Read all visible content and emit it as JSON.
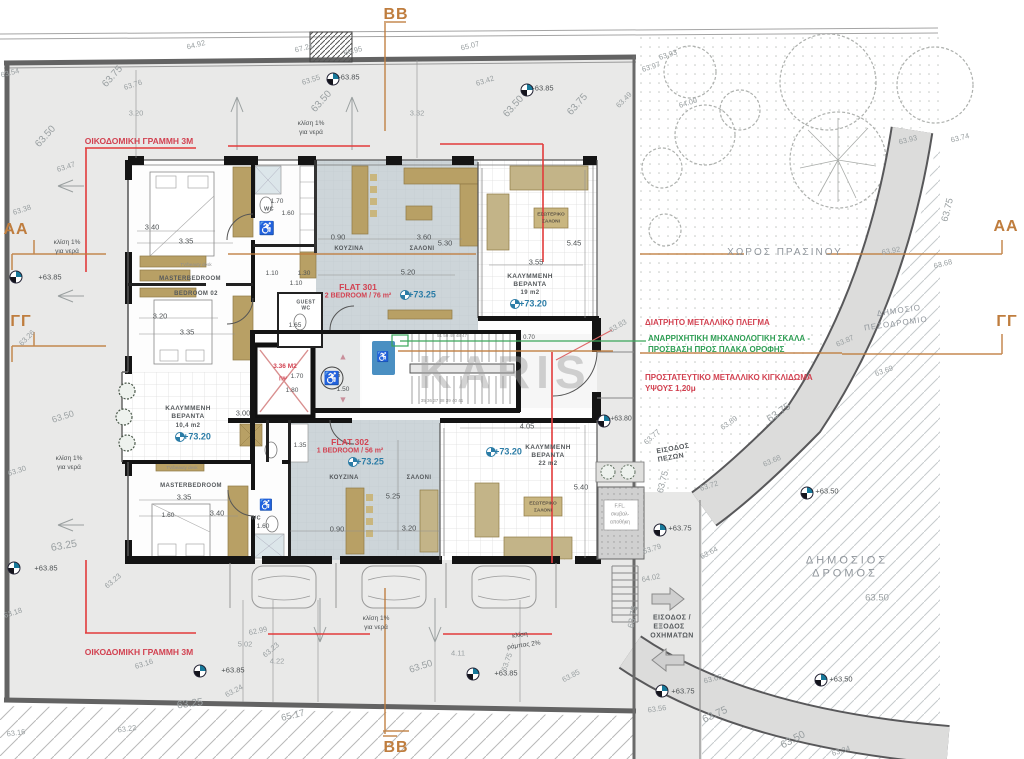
{
  "section_markers": {
    "top": "BB",
    "bottom": "BB",
    "left_a": "AA",
    "right_a": "AA",
    "left_g": "ΓΓ",
    "right_g": "ΓΓ"
  },
  "icons": {
    "wheelchair": "♿",
    "tri_up": "▲",
    "tri_down": "▼"
  },
  "flat301": {
    "name": "FLAT 301",
    "spec": "2 BEDROOM / 76 m²",
    "level": "+73.25"
  },
  "flat302": {
    "name": "FLAT 302",
    "spec": "1 BEDROOM / 56 m²",
    "level": "+73.25"
  },
  "labels": [
    {
      "n": "watermark",
      "t": "KARIS",
      "x": 505,
      "y": 372,
      "c": "wm",
      "s": 46,
      "ls": 6
    },
    {
      "n": "building-line-label-top",
      "t": "ΟΙΚΟΔΟΜΙΚΗ ΓΡΑΜΜΗ 3Μ",
      "x": 139,
      "y": 141,
      "c": "red",
      "s": 8.5
    },
    {
      "n": "building-line-label-bottom",
      "t": "ΟΙΚΟΔΟΜΙΚΗ ΓΡΑΜΜΗ 3Μ",
      "x": 139,
      "y": 652,
      "c": "red",
      "s": 8.5
    },
    {
      "n": "annotation-mesh",
      "t": "ΔΙΑΤΡΗΤΟ ΜΕΤΑΛΛΙΚΟ ΠΛΕΓΜΑ",
      "x": 645,
      "y": 323,
      "c": "red",
      "s": 8,
      "a": "l"
    },
    {
      "n": "annotation-ladder-1",
      "t": "ΑΝΑΡΡΙΧΗΤΙΚΗ ΜΗΧΑΝΟΛΟΓΙΚΗ ΣΚΑΛΑ -",
      "x": 648,
      "y": 339,
      "c": "grn",
      "s": 8,
      "a": "l"
    },
    {
      "n": "annotation-ladder-2",
      "t": "ΠΡΟΣΒΑΣΗ ΠΡΟΣ ΠΛΑΚΑ ΟΡΟΦΗΣ",
      "x": 648,
      "y": 350,
      "c": "grn",
      "s": 8,
      "a": "l"
    },
    {
      "n": "annotation-railing-1",
      "t": "ΠΡΟΣΤΑΤΕΥΤΙΚΟ ΜΕΤΑΛΛΙΚΟ ΚΙΓΚΛΙΔΩΜΑ",
      "x": 645,
      "y": 378,
      "c": "red",
      "s": 8,
      "a": "l"
    },
    {
      "n": "annotation-railing-2",
      "t": "ΥΨΟΥΣ 1,20μ",
      "x": 645,
      "y": 389,
      "c": "red",
      "s": 8,
      "a": "l"
    },
    {
      "n": "green-space-label",
      "t": "ΧΩΡΟΣ ΠΡΑΣΙΝΟΥ",
      "x": 785,
      "y": 253,
      "c": "rd",
      "s": 10,
      "ls": 2
    },
    {
      "n": "sidewalk-label-1",
      "t": "ΔΗΜΟΣΙΟ",
      "x": 899,
      "y": 311,
      "r": -8,
      "c": "rd",
      "s": 8,
      "ls": 1
    },
    {
      "n": "sidewalk-label-2",
      "t": "ΠΕΖΟΔΡΟΜΙΟ",
      "x": 896,
      "y": 324,
      "r": -8,
      "c": "rd",
      "s": 8,
      "ls": 1
    },
    {
      "n": "road-label-1",
      "t": "ΔΗΜΟΣΙΟΣ",
      "x": 847,
      "y": 561,
      "c": "rd",
      "s": 11,
      "ls": 3
    },
    {
      "n": "road-label-2",
      "t": "ΔΡΟΜΟΣ",
      "x": 845,
      "y": 574,
      "c": "rd",
      "s": 11,
      "ls": 3
    },
    {
      "n": "road-level",
      "t": "63.50",
      "x": 877,
      "y": 598,
      "c": "lv",
      "s": 9.5
    },
    {
      "n": "pedestrian-entrance-1",
      "t": "ΕΙΣΟΔΟΣ",
      "x": 673,
      "y": 449,
      "r": -10,
      "c": "rm",
      "s": 7
    },
    {
      "n": "pedestrian-entrance-2",
      "t": "ΠΕΖΩΝ",
      "x": 671,
      "y": 458,
      "r": -10,
      "c": "rm",
      "s": 7
    },
    {
      "n": "vehicle-entrance-1",
      "t": "ΕΙΣΟΔΟΣ /",
      "x": 672,
      "y": 618,
      "c": "rm",
      "s": 7
    },
    {
      "n": "vehicle-entrance-2",
      "t": "ΕΞΟΔΟΣ",
      "x": 669,
      "y": 627,
      "c": "rm",
      "s": 7
    },
    {
      "n": "vehicle-entrance-3",
      "t": "ΟΧΗΜΑΤΩΝ",
      "x": 672,
      "y": 636,
      "c": "rm",
      "s": 7
    },
    {
      "t": "64.92",
      "x": 196,
      "y": 45,
      "r": -14
    },
    {
      "t": "67.21",
      "x": 304,
      "y": 48,
      "r": -14
    },
    {
      "t": "66.95",
      "x": 353,
      "y": 51,
      "r": -14
    },
    {
      "t": "65.07",
      "x": 470,
      "y": 46,
      "r": -14
    },
    {
      "t": "63.54",
      "x": 10,
      "y": 73,
      "r": -14
    },
    {
      "t": "63.75",
      "x": 113,
      "y": 77,
      "r": -48,
      "s": 10
    },
    {
      "t": "63.76",
      "x": 133,
      "y": 85,
      "r": -18
    },
    {
      "t": "3.20",
      "x": 136,
      "y": 113,
      "c": "lv"
    },
    {
      "t": "63.55",
      "x": 311,
      "y": 80,
      "r": -18
    },
    {
      "t": "+63.85",
      "x": 348,
      "y": 77,
      "c": "dk"
    },
    {
      "t": "63.50",
      "x": 322,
      "y": 102,
      "r": -48,
      "s": 10
    },
    {
      "t": "κλίση 1%",
      "x": 311,
      "y": 124,
      "c": "dk",
      "s": 6.5
    },
    {
      "t": "για νερά",
      "x": 311,
      "y": 133,
      "c": "dk",
      "s": 6.5
    },
    {
      "t": "3.32",
      "x": 417,
      "y": 113,
      "c": "lv"
    },
    {
      "t": "63.42",
      "x": 485,
      "y": 81,
      "r": -18
    },
    {
      "t": "63.50",
      "x": 514,
      "y": 107,
      "r": -48,
      "s": 10
    },
    {
      "t": "+63.85",
      "x": 542,
      "y": 88,
      "c": "dk"
    },
    {
      "t": "63.75",
      "x": 578,
      "y": 105,
      "r": -48,
      "s": 10
    },
    {
      "t": "63.49",
      "x": 624,
      "y": 100,
      "r": -45
    },
    {
      "t": "63.93",
      "x": 668,
      "y": 55,
      "r": -18
    },
    {
      "t": "63.97",
      "x": 651,
      "y": 67,
      "r": -18
    },
    {
      "t": "64.00",
      "x": 688,
      "y": 103,
      "r": -18
    },
    {
      "t": "63.93",
      "x": 908,
      "y": 140,
      "r": -14
    },
    {
      "t": "63.74",
      "x": 960,
      "y": 138,
      "r": -14
    },
    {
      "t": "63.50",
      "x": 46,
      "y": 137,
      "r": -48,
      "s": 10
    },
    {
      "t": "63.47",
      "x": 66,
      "y": 167,
      "r": -18
    },
    {
      "t": "63.38",
      "x": 22,
      "y": 210,
      "r": -18
    },
    {
      "t": "κλίση 1%",
      "x": 67,
      "y": 243,
      "c": "dk",
      "s": 6.5
    },
    {
      "t": "για νερά",
      "x": 67,
      "y": 252,
      "c": "dk",
      "s": 6.5
    },
    {
      "t": "+63.85",
      "x": 50,
      "y": 277,
      "c": "dk"
    },
    {
      "t": "63.26",
      "x": 27,
      "y": 338,
      "r": -45
    },
    {
      "t": "63.50",
      "x": 63,
      "y": 417,
      "r": -18,
      "s": 9
    },
    {
      "t": "63.30",
      "x": 17,
      "y": 471,
      "r": -18
    },
    {
      "t": "κλίση 1%",
      "x": 69,
      "y": 459,
      "c": "dk",
      "s": 6.5
    },
    {
      "t": "για νερά",
      "x": 69,
      "y": 468,
      "c": "dk",
      "s": 6.5
    },
    {
      "t": "63.25",
      "x": 64,
      "y": 546,
      "r": -10,
      "s": 10.5
    },
    {
      "t": "+63.85",
      "x": 46,
      "y": 568,
      "c": "dk"
    },
    {
      "t": "63.18",
      "x": 13,
      "y": 613,
      "r": -18
    },
    {
      "t": "63.23",
      "x": 113,
      "y": 581,
      "r": -40
    },
    {
      "t": "62.99",
      "x": 258,
      "y": 631,
      "r": -12
    },
    {
      "t": "5.02",
      "x": 245,
      "y": 644
    },
    {
      "t": "63.23",
      "x": 271,
      "y": 650,
      "r": -40
    },
    {
      "t": "4.22",
      "x": 277,
      "y": 661
    },
    {
      "t": "63.16",
      "x": 144,
      "y": 664,
      "r": -18
    },
    {
      "t": "+63.85",
      "x": 233,
      "y": 670,
      "c": "dk"
    },
    {
      "t": "63.24",
      "x": 234,
      "y": 691,
      "r": -28
    },
    {
      "t": "63.25",
      "x": 190,
      "y": 704,
      "r": -8,
      "s": 10.5
    },
    {
      "t": "63.22",
      "x": 127,
      "y": 729,
      "r": -8
    },
    {
      "t": "63.16",
      "x": 16,
      "y": 733,
      "r": -8
    },
    {
      "t": "65.17",
      "x": 293,
      "y": 716,
      "r": -14,
      "s": 9.5
    },
    {
      "t": "κλίση 1%",
      "x": 376,
      "y": 619,
      "c": "dk",
      "s": 6.5
    },
    {
      "t": "για νερά",
      "x": 376,
      "y": 628,
      "c": "dk",
      "s": 6.5
    },
    {
      "t": "63.50",
      "x": 421,
      "y": 667,
      "r": -18,
      "s": 9.5
    },
    {
      "t": "4.11",
      "x": 458,
      "y": 653
    },
    {
      "t": "+63.85",
      "x": 506,
      "y": 673,
      "c": "dk"
    },
    {
      "t": "63.75",
      "x": 507,
      "y": 662,
      "r": -70
    },
    {
      "t": "κλίση",
      "x": 520,
      "y": 636,
      "r": -8,
      "c": "dk",
      "s": 6.5
    },
    {
      "t": "ράμπας 2%",
      "x": 524,
      "y": 646,
      "r": -8,
      "c": "dk",
      "s": 6.5
    },
    {
      "t": "63.85",
      "x": 571,
      "y": 676,
      "r": -28
    },
    {
      "t": "63.75",
      "x": 948,
      "y": 210,
      "r": -76,
      "s": 9.5
    },
    {
      "t": "63.92",
      "x": 891,
      "y": 251,
      "r": -10
    },
    {
      "t": "63.68",
      "x": 943,
      "y": 264,
      "r": -14
    },
    {
      "t": "63.87",
      "x": 845,
      "y": 341,
      "r": -24
    },
    {
      "t": "63.69",
      "x": 884,
      "y": 371,
      "r": -20
    },
    {
      "t": "63.83",
      "x": 618,
      "y": 326,
      "r": -30
    },
    {
      "t": "63.75",
      "x": 779,
      "y": 413,
      "r": -35,
      "s": 10.5
    },
    {
      "t": "63.89",
      "x": 729,
      "y": 423,
      "r": -35
    },
    {
      "t": "63.77",
      "x": 652,
      "y": 437,
      "r": -42
    },
    {
      "t": "63.68",
      "x": 772,
      "y": 461,
      "r": -24
    },
    {
      "t": "+63.80",
      "x": 621,
      "y": 419,
      "c": "dk",
      "s": 7
    },
    {
      "t": "63.75",
      "x": 663,
      "y": 482,
      "r": -76,
      "s": 9
    },
    {
      "t": "63.72",
      "x": 709,
      "y": 486,
      "r": -18
    },
    {
      "t": "+63.75",
      "x": 680,
      "y": 528,
      "c": "dk"
    },
    {
      "t": "63.79",
      "x": 652,
      "y": 549,
      "r": -18
    },
    {
      "t": "63.64",
      "x": 709,
      "y": 553,
      "r": -28
    },
    {
      "t": "64.02",
      "x": 651,
      "y": 578,
      "r": -12
    },
    {
      "t": "+63.50",
      "x": 827,
      "y": 491,
      "c": "dk"
    },
    {
      "t": "63.75",
      "x": 633,
      "y": 617,
      "r": -80,
      "s": 9
    },
    {
      "t": "63.65",
      "x": 713,
      "y": 679,
      "r": -14
    },
    {
      "t": "+63.75",
      "x": 683,
      "y": 691,
      "c": "dk"
    },
    {
      "t": "63.56",
      "x": 657,
      "y": 709,
      "r": -8
    },
    {
      "t": "63.75",
      "x": 715,
      "y": 715,
      "r": -24,
      "s": 10.5
    },
    {
      "t": "63.50",
      "x": 793,
      "y": 740,
      "r": -28,
      "s": 10.5
    },
    {
      "t": "63.34",
      "x": 841,
      "y": 751,
      "r": -18
    },
    {
      "t": "+63.50",
      "x": 841,
      "y": 679,
      "c": "dk"
    },
    {
      "t": "3.40",
      "x": 152,
      "y": 227,
      "c": "dk"
    },
    {
      "t": "3.35",
      "x": 186,
      "y": 241,
      "c": "dk"
    },
    {
      "n": "room-masterbedroom-301",
      "t": "MASTERBEDROOM",
      "x": 190,
      "y": 279,
      "c": "rm",
      "s": 6
    },
    {
      "t": "TV/beauty desk",
      "x": 196,
      "y": 265,
      "c": "tiny",
      "s": 4.5
    },
    {
      "t": "1.70",
      "x": 277,
      "y": 202,
      "c": "dk",
      "s": 6.5
    },
    {
      "n": "room-wc-301",
      "t": "WC",
      "x": 269,
      "y": 210,
      "c": "rm",
      "s": 5.5
    },
    {
      "t": "1.60",
      "x": 288,
      "y": 214,
      "c": "dk",
      "s": 6.5
    },
    {
      "t": "0.90",
      "x": 338,
      "y": 237,
      "c": "dk"
    },
    {
      "n": "room-kitchen-301",
      "t": "ΚΟΥΖΙΝΑ",
      "x": 349,
      "y": 249,
      "c": "rm",
      "s": 6
    },
    {
      "t": "3.60",
      "x": 424,
      "y": 237,
      "c": "dk"
    },
    {
      "n": "room-living-301",
      "t": "ΣΑΛΟΝΙ",
      "x": 422,
      "y": 249,
      "c": "rm",
      "s": 6
    },
    {
      "t": "5.30",
      "x": 445,
      "y": 243,
      "c": "dk"
    },
    {
      "t": "5.20",
      "x": 408,
      "y": 272,
      "c": "dk"
    },
    {
      "t": "1.10",
      "x": 272,
      "y": 274,
      "c": "dk",
      "s": 6.5
    },
    {
      "t": "1.30",
      "x": 304,
      "y": 274,
      "c": "dk",
      "s": 6.5
    },
    {
      "t": "1.10",
      "x": 296,
      "y": 284,
      "c": "dk",
      "s": 6.5
    },
    {
      "n": "room-bedroom02",
      "t": "BEDROOM 02",
      "x": 196,
      "y": 294,
      "c": "rm",
      "s": 6
    },
    {
      "t": "3.20",
      "x": 160,
      "y": 316,
      "c": "dk"
    },
    {
      "t": "3.35",
      "x": 187,
      "y": 332,
      "c": "dk"
    },
    {
      "t": "GUEST",
      "x": 306,
      "y": 303,
      "c": "rm",
      "s": 5
    },
    {
      "t": "WC",
      "x": 306,
      "y": 309,
      "c": "rm",
      "s": 5
    },
    {
      "t": "1.65",
      "x": 295,
      "y": 326,
      "c": "dk",
      "s": 6.5
    },
    {
      "n": "flat-301-name",
      "t": "FLAT 301",
      "x": 358,
      "y": 287,
      "c": "red",
      "s": 8.5
    },
    {
      "n": "flat-301-spec",
      "t": "2 BEDROOM / 76 m²",
      "x": 358,
      "y": 296,
      "c": "red",
      "s": 7
    },
    {
      "n": "flat-301-level",
      "t": "+73.25",
      "x": 422,
      "y": 295,
      "c": "blu",
      "s": 9
    },
    {
      "t": "ΕΣΩΤΕΡΙΚΟ",
      "x": 551,
      "y": 216,
      "c": "tanlbl",
      "s": 4.8
    },
    {
      "t": "ΣΑΛΟΝΙ",
      "x": 551,
      "y": 223,
      "c": "tanlbl",
      "s": 4.8
    },
    {
      "n": "veranda-19-1",
      "t": "ΚΑΛΥΜΜΕΝΗ",
      "x": 530,
      "y": 277,
      "c": "rm",
      "s": 6.5
    },
    {
      "n": "veranda-19-2",
      "t": "ΒΕΡΑΝΤΑ",
      "x": 530,
      "y": 285,
      "c": "rm",
      "s": 6.5
    },
    {
      "n": "veranda-19-area",
      "t": "19  m2",
      "x": 530,
      "y": 293,
      "c": "rm",
      "s": 6
    },
    {
      "n": "veranda-19-level",
      "t": "+73.20",
      "x": 533,
      "y": 304,
      "c": "blu",
      "s": 9
    },
    {
      "t": "3.55",
      "x": 536,
      "y": 262,
      "c": "dk"
    },
    {
      "t": "5.45",
      "x": 574,
      "y": 243,
      "c": "dk"
    },
    {
      "n": "elevator-area",
      "t": "3.36 Μ2",
      "x": 285,
      "y": 367,
      "c": "red",
      "s": 6.5
    },
    {
      "t": "ΠΨ",
      "x": 283,
      "y": 380,
      "c": "red",
      "s": 5
    },
    {
      "t": "1.70",
      "x": 297,
      "y": 377,
      "c": "dk",
      "s": 6.5
    },
    {
      "t": "1.80",
      "x": 292,
      "y": 391,
      "c": "dk",
      "s": 6.5
    },
    {
      "t": "1.85",
      "x": 334,
      "y": 376,
      "c": "dk",
      "s": 6.5
    },
    {
      "t": "1.50",
      "x": 343,
      "y": 390,
      "c": "dk",
      "s": 6.5
    },
    {
      "t": "0.70",
      "x": 529,
      "y": 338,
      "c": "dk",
      "s": 6
    },
    {
      "t": "51 50 49 48 47",
      "x": 452,
      "y": 336,
      "c": "tiny",
      "s": 4.5
    },
    {
      "t": "35 36 37 38 39 40 41",
      "x": 442,
      "y": 401,
      "c": "tiny",
      "s": 4.5
    },
    {
      "n": "flat-302-name",
      "t": "FLAT 302",
      "x": 350,
      "y": 442,
      "c": "red",
      "s": 8.5
    },
    {
      "n": "flat-302-spec",
      "t": "1 BEDROOM / 56 m²",
      "x": 350,
      "y": 451,
      "c": "red",
      "s": 7
    },
    {
      "n": "flat-302-level",
      "t": "+73.25",
      "x": 370,
      "y": 462,
      "c": "blu",
      "s": 9
    },
    {
      "n": "veranda-104-1",
      "t": "ΚΑΛΥΜΜΕΝΗ",
      "x": 188,
      "y": 409,
      "c": "rm",
      "s": 6.5
    },
    {
      "n": "veranda-104-2",
      "t": "ΒΕΡΑΝΤΑ",
      "x": 188,
      "y": 417,
      "c": "rm",
      "s": 6.5
    },
    {
      "n": "veranda-104-area",
      "t": "10,4 m2",
      "x": 188,
      "y": 426,
      "c": "rm",
      "s": 6
    },
    {
      "n": "veranda-104-level",
      "t": "+73.20",
      "x": 197,
      "y": 437,
      "c": "blu",
      "s": 9
    },
    {
      "t": "3.00",
      "x": 243,
      "y": 413,
      "c": "dk"
    },
    {
      "t": "1.35",
      "x": 300,
      "y": 446,
      "c": "dk",
      "s": 6.5
    },
    {
      "t": "TV/beauty desk",
      "x": 182,
      "y": 468,
      "c": "tiny",
      "s": 4.5
    },
    {
      "n": "room-masterbedroom-302",
      "t": "MASTERBEDROOM",
      "x": 191,
      "y": 486,
      "c": "rm",
      "s": 6
    },
    {
      "t": "3.35",
      "x": 184,
      "y": 497,
      "c": "dk"
    },
    {
      "t": "3.40",
      "x": 217,
      "y": 513,
      "c": "dk"
    },
    {
      "t": "1.60",
      "x": 168,
      "y": 516,
      "c": "dk",
      "s": 6.5
    },
    {
      "n": "room-wc-302",
      "t": "WC",
      "x": 256,
      "y": 519,
      "c": "rm",
      "s": 5.5
    },
    {
      "t": "1.60",
      "x": 263,
      "y": 527,
      "c": "dk",
      "s": 6.5
    },
    {
      "n": "room-kitchen-302",
      "t": "ΚΟΥΖΙΝΑ",
      "x": 344,
      "y": 478,
      "c": "rm",
      "s": 6
    },
    {
      "t": "0.90",
      "x": 337,
      "y": 529,
      "c": "dk"
    },
    {
      "t": "5.25",
      "x": 393,
      "y": 496,
      "c": "dk"
    },
    {
      "n": "room-living-302",
      "t": "ΣΑΛΟΝΙ",
      "x": 419,
      "y": 478,
      "c": "rm",
      "s": 6
    },
    {
      "t": "3.20",
      "x": 409,
      "y": 528,
      "c": "dk"
    },
    {
      "n": "veranda-22-1",
      "t": "ΚΑΛΥΜΜΕΝΗ",
      "x": 548,
      "y": 448,
      "c": "rm",
      "s": 6.5
    },
    {
      "n": "veranda-22-2",
      "t": "ΒΕΡΑΝΤΑ",
      "x": 548,
      "y": 456,
      "c": "rm",
      "s": 6.5
    },
    {
      "n": "veranda-22-area",
      "t": "22 m2",
      "x": 548,
      "y": 464,
      "c": "rm",
      "s": 6
    },
    {
      "n": "veranda-22-level",
      "t": "+73.20",
      "x": 508,
      "y": 452,
      "c": "blu",
      "s": 9
    },
    {
      "t": "4.05",
      "x": 527,
      "y": 426,
      "c": "dk"
    },
    {
      "t": "5.40",
      "x": 581,
      "y": 487,
      "c": "dk"
    },
    {
      "t": "ΕΣΩΤΕΡΙΚΟ",
      "x": 543,
      "y": 505,
      "c": "tanlbl",
      "s": 4.8
    },
    {
      "t": "ΣΑΛΟΝΙ",
      "x": 543,
      "y": 512,
      "c": "tanlbl",
      "s": 4.8
    },
    {
      "n": "storage-1",
      "t": "F.FL.",
      "x": 620,
      "y": 507,
      "c": "tiny",
      "s": 5
    },
    {
      "n": "storage-2",
      "t": "σκυβαλ-",
      "x": 620,
      "y": 515,
      "c": "tiny",
      "s": 5
    },
    {
      "n": "storage-3",
      "t": "αποθήκη",
      "x": 620,
      "y": 523,
      "c": "tiny",
      "s": 5
    }
  ],
  "survey_markers": [
    {
      "x": 333,
      "y": 79
    },
    {
      "x": 527,
      "y": 90
    },
    {
      "x": 16,
      "y": 277
    },
    {
      "x": 14,
      "y": 568
    },
    {
      "x": 200,
      "y": 671
    },
    {
      "x": 473,
      "y": 674
    },
    {
      "x": 604,
      "y": 421
    },
    {
      "x": 660,
      "y": 530
    },
    {
      "x": 807,
      "y": 493
    },
    {
      "x": 821,
      "y": 680
    },
    {
      "x": 662,
      "y": 691
    }
  ],
  "level_flags": [
    {
      "x": 405,
      "y": 295
    },
    {
      "x": 515,
      "y": 304
    },
    {
      "x": 353,
      "y": 462
    },
    {
      "x": 180,
      "y": 437
    },
    {
      "x": 491,
      "y": 452
    }
  ],
  "decor_icons": [
    {
      "g": "wheelchair",
      "x": 267,
      "y": 228,
      "s": 13,
      "c": "#222222"
    },
    {
      "g": "wheelchair",
      "x": 332,
      "y": 378,
      "s": 13,
      "c": "#222222"
    },
    {
      "g": "wheelchair",
      "x": 266,
      "y": 506,
      "s": 11,
      "c": "#222222"
    },
    {
      "g": "wheelchair",
      "x": 383,
      "y": 358,
      "s": 10,
      "c": "#ffffff"
    },
    {
      "g": "tri_up",
      "x": 343,
      "y": 357,
      "s": 9,
      "c": "#c98f9b"
    },
    {
      "g": "tri_down",
      "x": 343,
      "y": 400,
      "s": 9,
      "c": "#c98f9b"
    }
  ]
}
